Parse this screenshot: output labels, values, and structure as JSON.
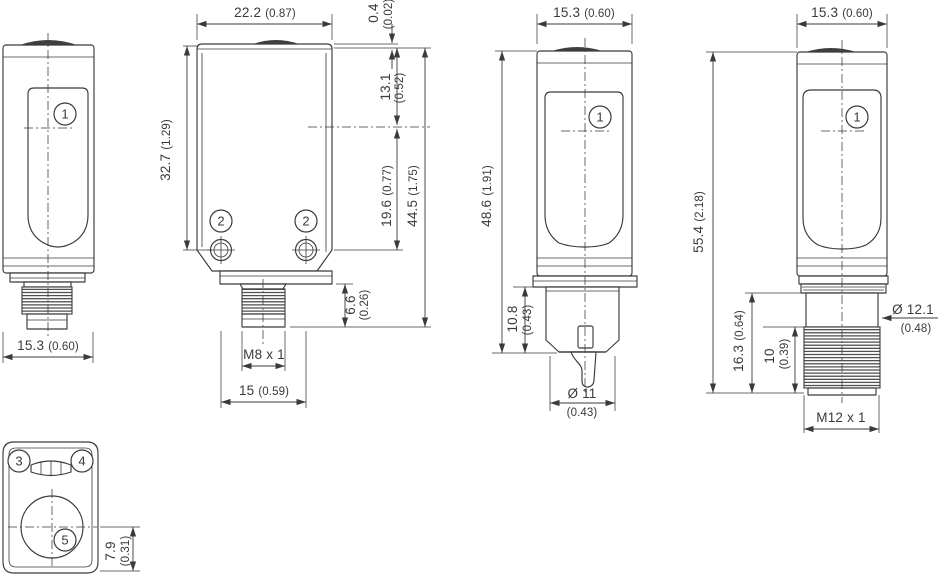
{
  "drawing_title": "Photoelectric sensor dimensional drawing",
  "colors": {
    "line": "#3a3a3a",
    "background": "#ffffff",
    "cap_fill": "#3f3f3f"
  },
  "views": {
    "front_m8": {
      "callout": "1",
      "width": {
        "mm": "15.3",
        "in": "(0.60)"
      }
    },
    "side": {
      "callout_hole_left": "2",
      "callout_hole_right": "2",
      "width": {
        "mm": "22.2",
        "in": "(0.87)"
      },
      "body_height": {
        "mm": "32.7",
        "in": "(1.29)"
      },
      "lens_offset": {
        "mm": "0.4",
        "in": "(0.02)"
      },
      "top_to_axis": {
        "mm": "13.1",
        "in": "(0.52)"
      },
      "axis_to_hole": {
        "mm": "19.6",
        "in": "(0.77)"
      },
      "total_height": {
        "mm": "44.5",
        "in": "(1.75)"
      },
      "connector_length": {
        "mm": "6.6",
        "in": "(0.26)"
      },
      "thread": "M8 x 1",
      "hole_spacing": {
        "mm": "15",
        "in": "(0.59)"
      }
    },
    "front_cable": {
      "callout": "1",
      "width": {
        "mm": "15.3",
        "in": "(0.60)"
      },
      "height": {
        "mm": "48.6",
        "in": "(1.91)"
      },
      "gland_length": {
        "mm": "10.8",
        "in": "(0.43)"
      },
      "cable_diameter": {
        "mm": "Ø 11",
        "in": "(0.43)"
      }
    },
    "front_m12": {
      "callout": "1",
      "width": {
        "mm": "15.3",
        "in": "(0.60)"
      },
      "height": {
        "mm": "55.4",
        "in": "(2.18)"
      },
      "connector_length": {
        "mm": "16.3",
        "in": "(0.64)"
      },
      "thread_length": {
        "mm": "10",
        "in": "(0.39)"
      },
      "connector_diameter": {
        "mm": "Ø 12.1",
        "in": "(0.48)"
      },
      "thread": "M12 x 1"
    },
    "face": {
      "callout_left": "3",
      "callout_right": "4",
      "callout_lens": "5",
      "axis_to_bottom": {
        "mm": "7.9",
        "in": "(0.31)"
      }
    }
  }
}
